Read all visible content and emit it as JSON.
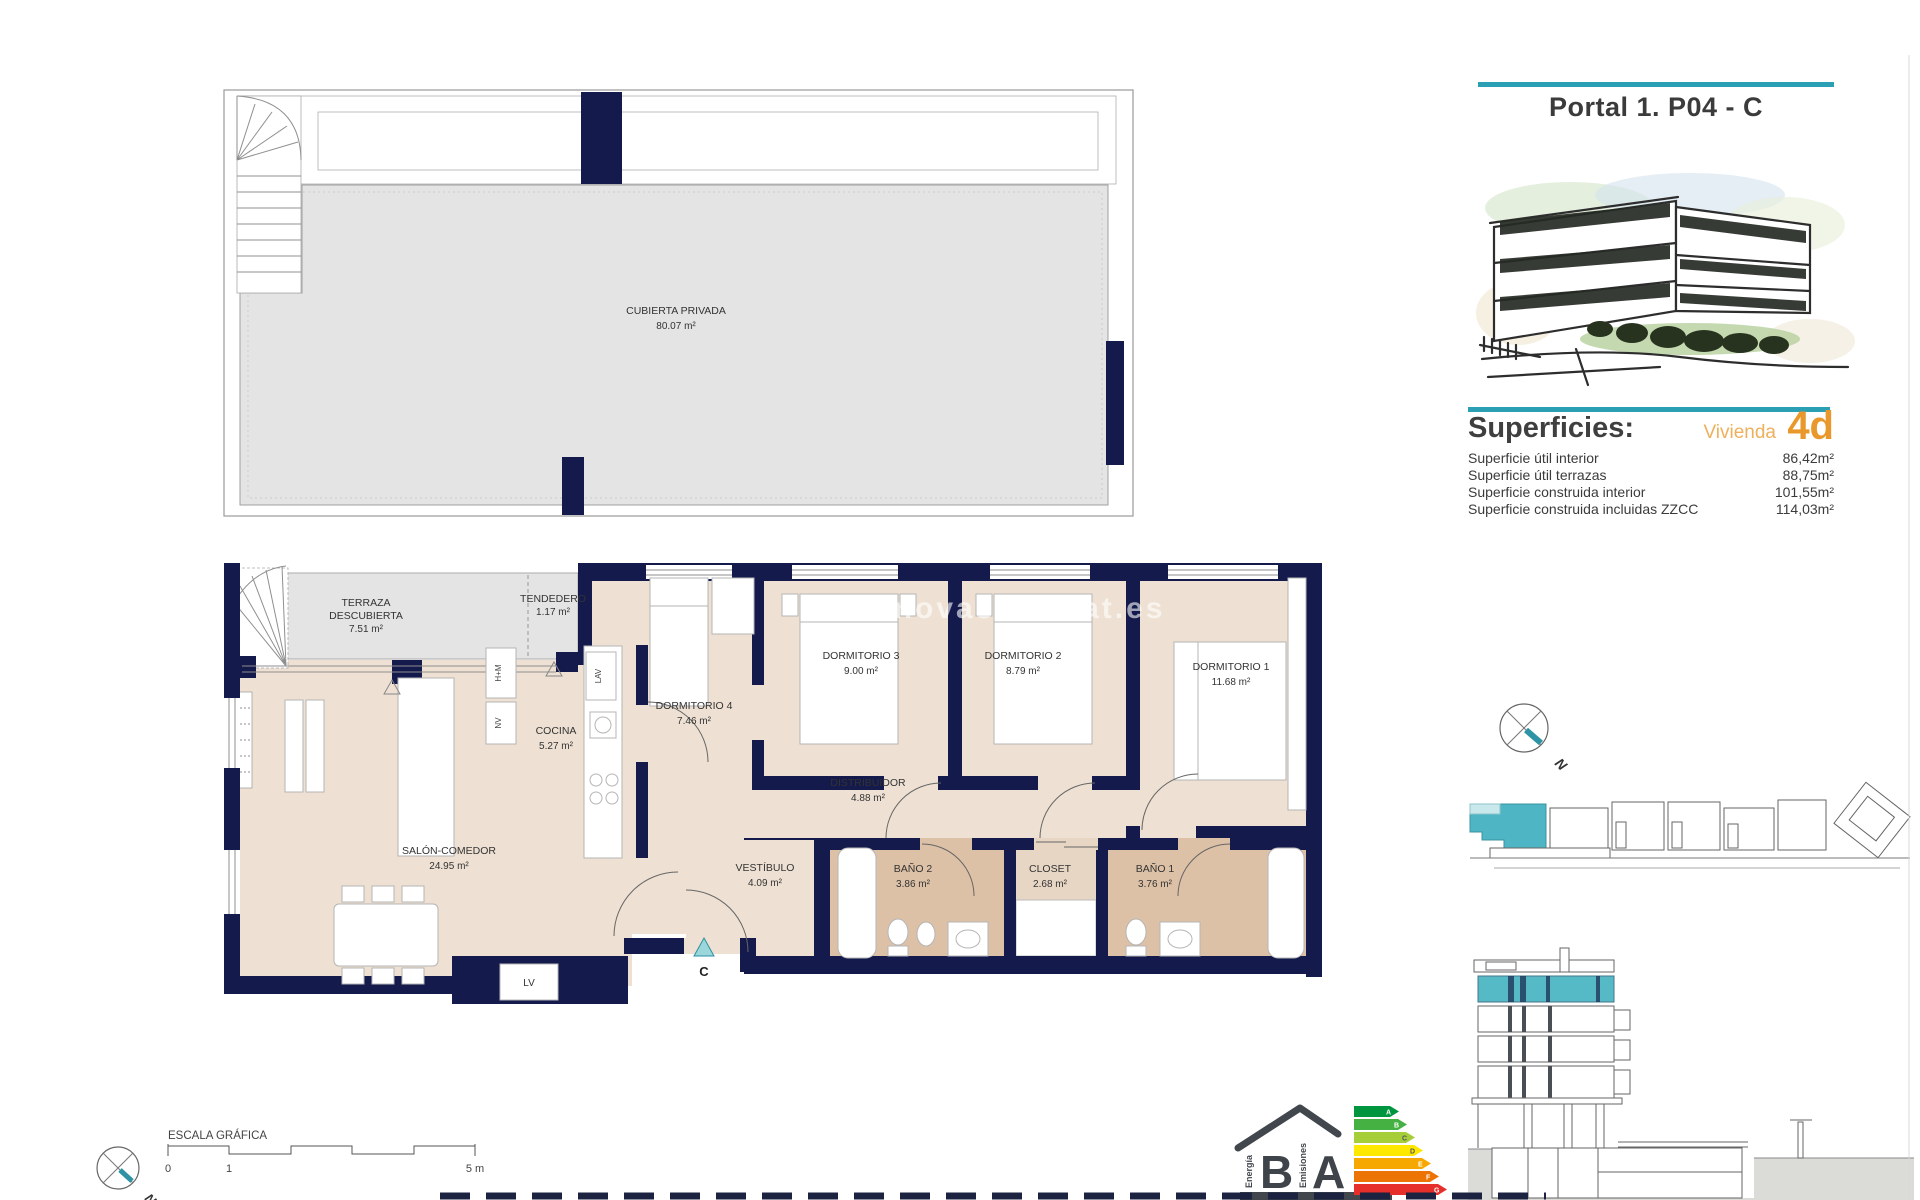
{
  "header": {
    "title": "Portal 1. P04 - C",
    "accent_color": "#2b9fb3"
  },
  "superficies": {
    "heading": "Superficies:",
    "vivienda_label": "Vivienda",
    "vivienda_code": "4d",
    "accent_orange": "#e9992c",
    "rows": [
      {
        "label": "Superficie útil interior",
        "value": "86,42m²"
      },
      {
        "label": "Superficie útil terrazas",
        "value": "88,75m²"
      },
      {
        "label": "Superficie construida interior",
        "value": "101,55m²"
      },
      {
        "label": "Superficie construida incluidas ZZCC",
        "value": "114,03m²"
      }
    ]
  },
  "plan": {
    "watermark": "www.novashabitat.es",
    "wall_color": "#141a4b",
    "floor_color": "#eee1d3",
    "terrace_color": "#e4e4e4",
    "highlight_teal": "#4db5c3",
    "upper_room": {
      "name": "CUBIERTA PRIVADA",
      "area": "80.07 m²"
    },
    "rooms": {
      "terraza": {
        "line1": "TERRAZA",
        "line2": "DESCUBIERTA",
        "area": "7.51 m²"
      },
      "tendedero": {
        "name": "TENDEDERO",
        "area": "1.17 m²"
      },
      "cocina": {
        "name": "COCINA",
        "area": "5.27 m²"
      },
      "dormitorio4": {
        "name": "DORMITORIO 4",
        "area": "7.46 m²"
      },
      "dormitorio3": {
        "name": "DORMITORIO 3",
        "area": "9.00 m²"
      },
      "dormitorio2": {
        "name": "DORMITORIO 2",
        "area": "8.79 m²"
      },
      "dormitorio1": {
        "name": "DORMITORIO 1",
        "area": "11.68 m²"
      },
      "distribuidor": {
        "name": "DISTRIBUIDOR",
        "area": "4.88 m²"
      },
      "salon": {
        "name": "SALÓN-COMEDOR",
        "area": "24.95 m²"
      },
      "vestibulo": {
        "name": "VESTÍBULO",
        "area": "4.09 m²"
      },
      "bano2": {
        "name": "BAÑO 2",
        "area": "3.86 m²"
      },
      "closet": {
        "name": "CLOSET",
        "area": "2.68 m²"
      },
      "bano1": {
        "name": "BAÑO 1",
        "area": "3.76 m²"
      }
    },
    "appliances": {
      "horno_micro": "H+M",
      "nevera": "NV",
      "lavadora": "LAV",
      "lavadero": "LV"
    },
    "entrance_letter": "C"
  },
  "scale_bar": {
    "title": "ESCALA GRÁFICA",
    "tick0": "0",
    "tick1": "1",
    "tick5": "5 m"
  },
  "compass": {
    "north": "N"
  },
  "energy": {
    "letter_b": "B",
    "letter_a": "A",
    "energia": "Energía",
    "emisiones": "Emisiones",
    "levels": [
      "A",
      "B",
      "C",
      "D",
      "E",
      "F",
      "G"
    ]
  }
}
